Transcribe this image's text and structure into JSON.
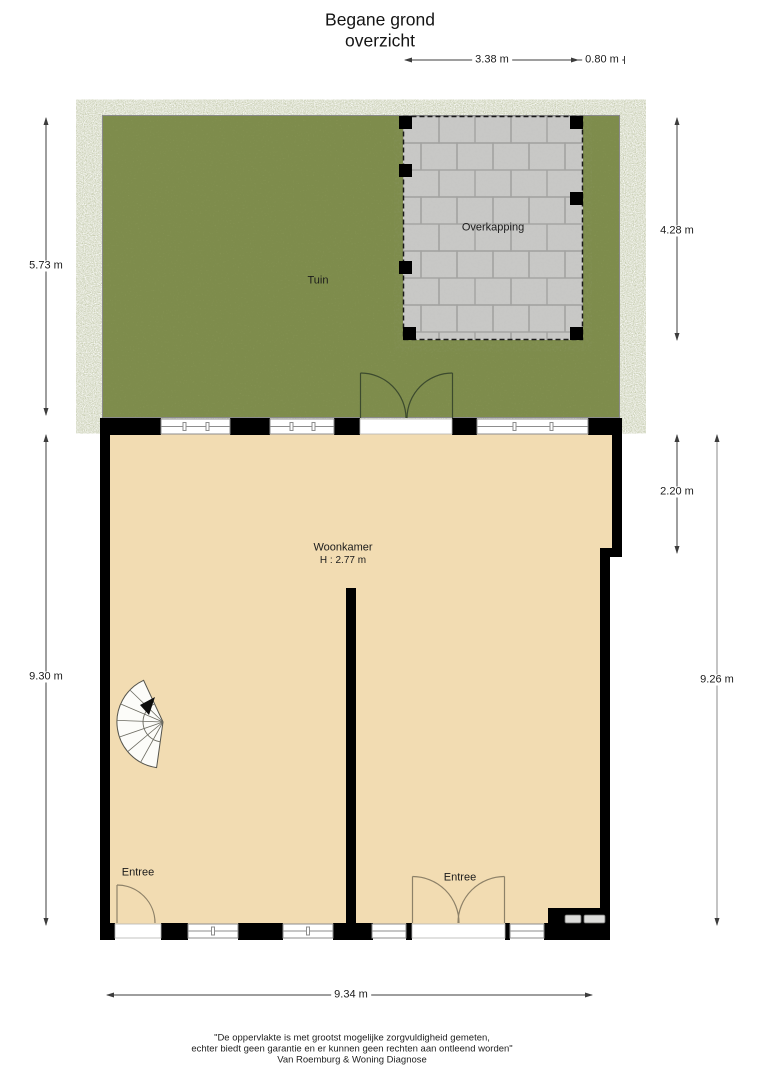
{
  "title": {
    "line1": "Begane grond",
    "line2": "overzicht"
  },
  "rooms": {
    "tuin": "Tuin",
    "overkapping": "Overkapping",
    "woonkamer": "Woonkamer",
    "woonkamer_height": "H : 2.77 m",
    "entree_left": "Entree",
    "entree_right": "Entree"
  },
  "dimensions": {
    "overkapping_width": "3.38 m",
    "side_strip_width": "0.80 m",
    "tuin_depth": "5.73 m",
    "overkapping_depth": "4.28 m",
    "woonkamer_upper_depth": "2.20 m",
    "interior_depth_left": "9.30 m",
    "interior_depth_right": "9.26 m",
    "house_width": "9.34 m"
  },
  "footer": {
    "disclaimer_line1": "\"De oppervlakte is met grootst mogelijke zorgvuldigheid gemeten,",
    "disclaimer_line2": "echter biedt geen garantie en er kunnen geen rechten aan ontleend worden\"",
    "company": "Van Roemburg & Woning Diagnose"
  },
  "colors": {
    "grass": "#7d8c4b",
    "paving": "#c8c8c6",
    "paving_joint": "#a3a3a1",
    "floor": "#f2dcb2",
    "wall": "#000000",
    "dimension_line": "#3c3c3c"
  }
}
